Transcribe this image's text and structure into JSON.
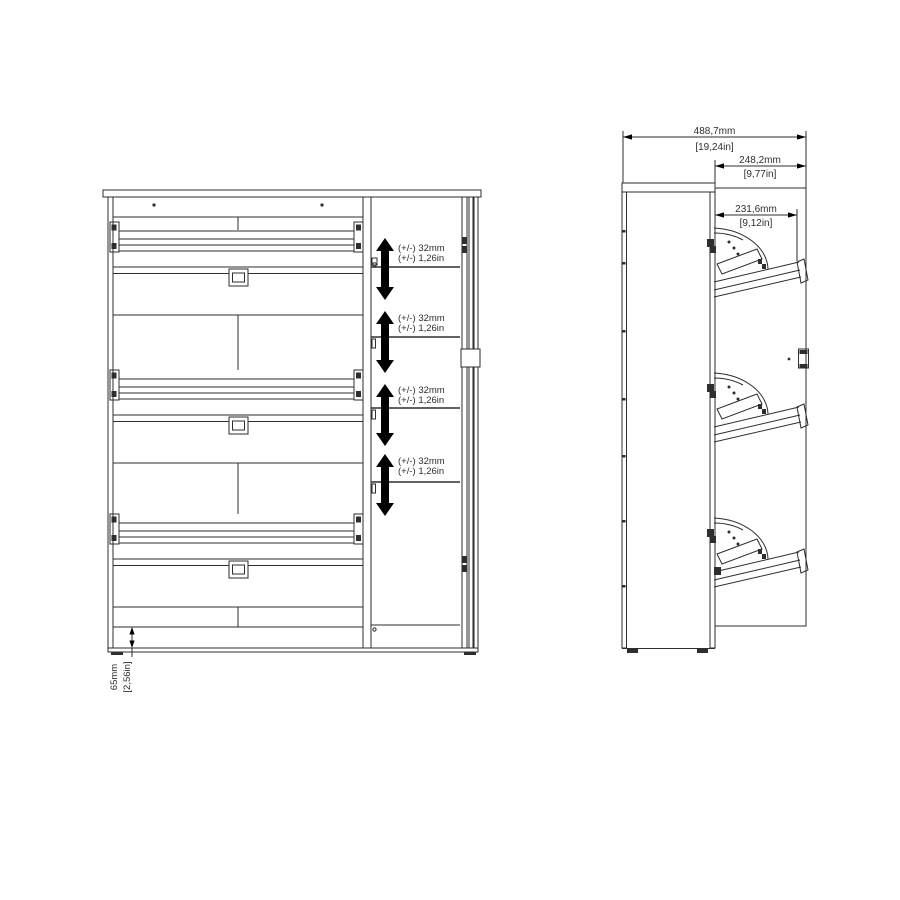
{
  "drawing": {
    "type": "furniture-technical-drawing",
    "subject": "shoe-cabinet-with-tilting-drawers-and-door"
  },
  "front_view": {
    "shelf_adjust_labels": [
      {
        "line1": "(+/-) 32mm",
        "line2": "(+/-) 1,26in"
      },
      {
        "line1": "(+/-) 32mm",
        "line2": "(+/-) 1,26in"
      },
      {
        "line1": "(+/-) 32mm",
        "line2": "(+/-) 1,26in"
      },
      {
        "line1": "(+/-) 32mm",
        "line2": "(+/-) 1,26in"
      }
    ],
    "plinth_dimension": {
      "mm": "65mm",
      "inches": "[2,56in]"
    }
  },
  "side_view": {
    "dimensions": [
      {
        "mm": "488,7mm",
        "inches": "[19,24in]"
      },
      {
        "mm": "248,2mm",
        "inches": "[9,77in]"
      },
      {
        "mm": "231,6mm",
        "inches": "[9,12in]"
      }
    ]
  },
  "icons": {
    "shelf_adjust": "double-headed-vertical-arrow",
    "dimension_arrows": "outward-pointing-dimension-arrowheads"
  },
  "colors": {
    "line": "#2e2e2e",
    "arrow": "#000000",
    "background": "#ffffff"
  }
}
